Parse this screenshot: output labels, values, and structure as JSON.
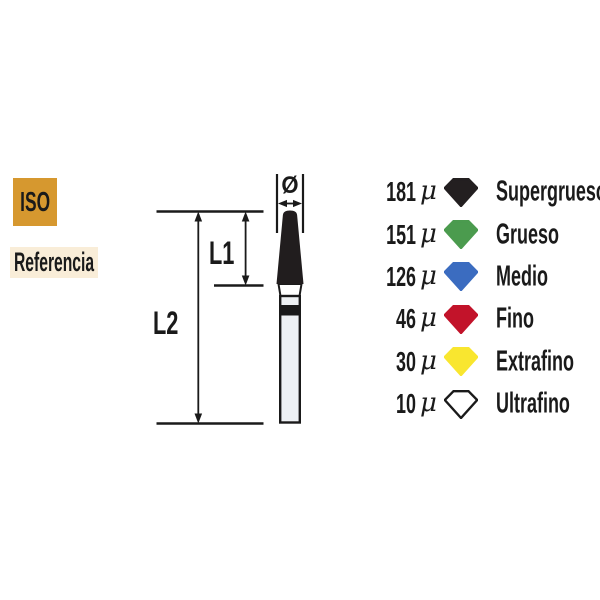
{
  "labels": {
    "iso": {
      "text": "ISO",
      "bg": "#d6982f"
    },
    "referencia": {
      "text": "Referencia",
      "bg": "#f9edd8"
    }
  },
  "diagram": {
    "dim_l1": "L1",
    "dim_l2": "L2",
    "diameter_symbol": "Ø",
    "line_color": "#1a1a1a",
    "head_color": "#211d1e",
    "neck_fill": "#ffffff",
    "shank_fill": "#eef1f4",
    "band_color": "#1a1a1a"
  },
  "legend": {
    "mu_symbol": "μ",
    "rows": [
      {
        "size": "181",
        "label": "Supergrueso",
        "color": "#231f20",
        "stroke": "#231f20"
      },
      {
        "size": "151",
        "label": "Grueso",
        "color": "#4b9b4e",
        "stroke": "#4b9b4e"
      },
      {
        "size": "126",
        "label": "Medio",
        "color": "#3b6cc0",
        "stroke": "#3b6cc0"
      },
      {
        "size": "46",
        "label": "Fino",
        "color": "#c2132a",
        "stroke": "#c2132a"
      },
      {
        "size": "30",
        "label": "Extrafino",
        "color": "#f9e62f",
        "stroke": "#f9e62f"
      },
      {
        "size": "10",
        "label": "Ultrafino",
        "color": "#ffffff",
        "stroke": "#1a1a1a"
      }
    ]
  }
}
